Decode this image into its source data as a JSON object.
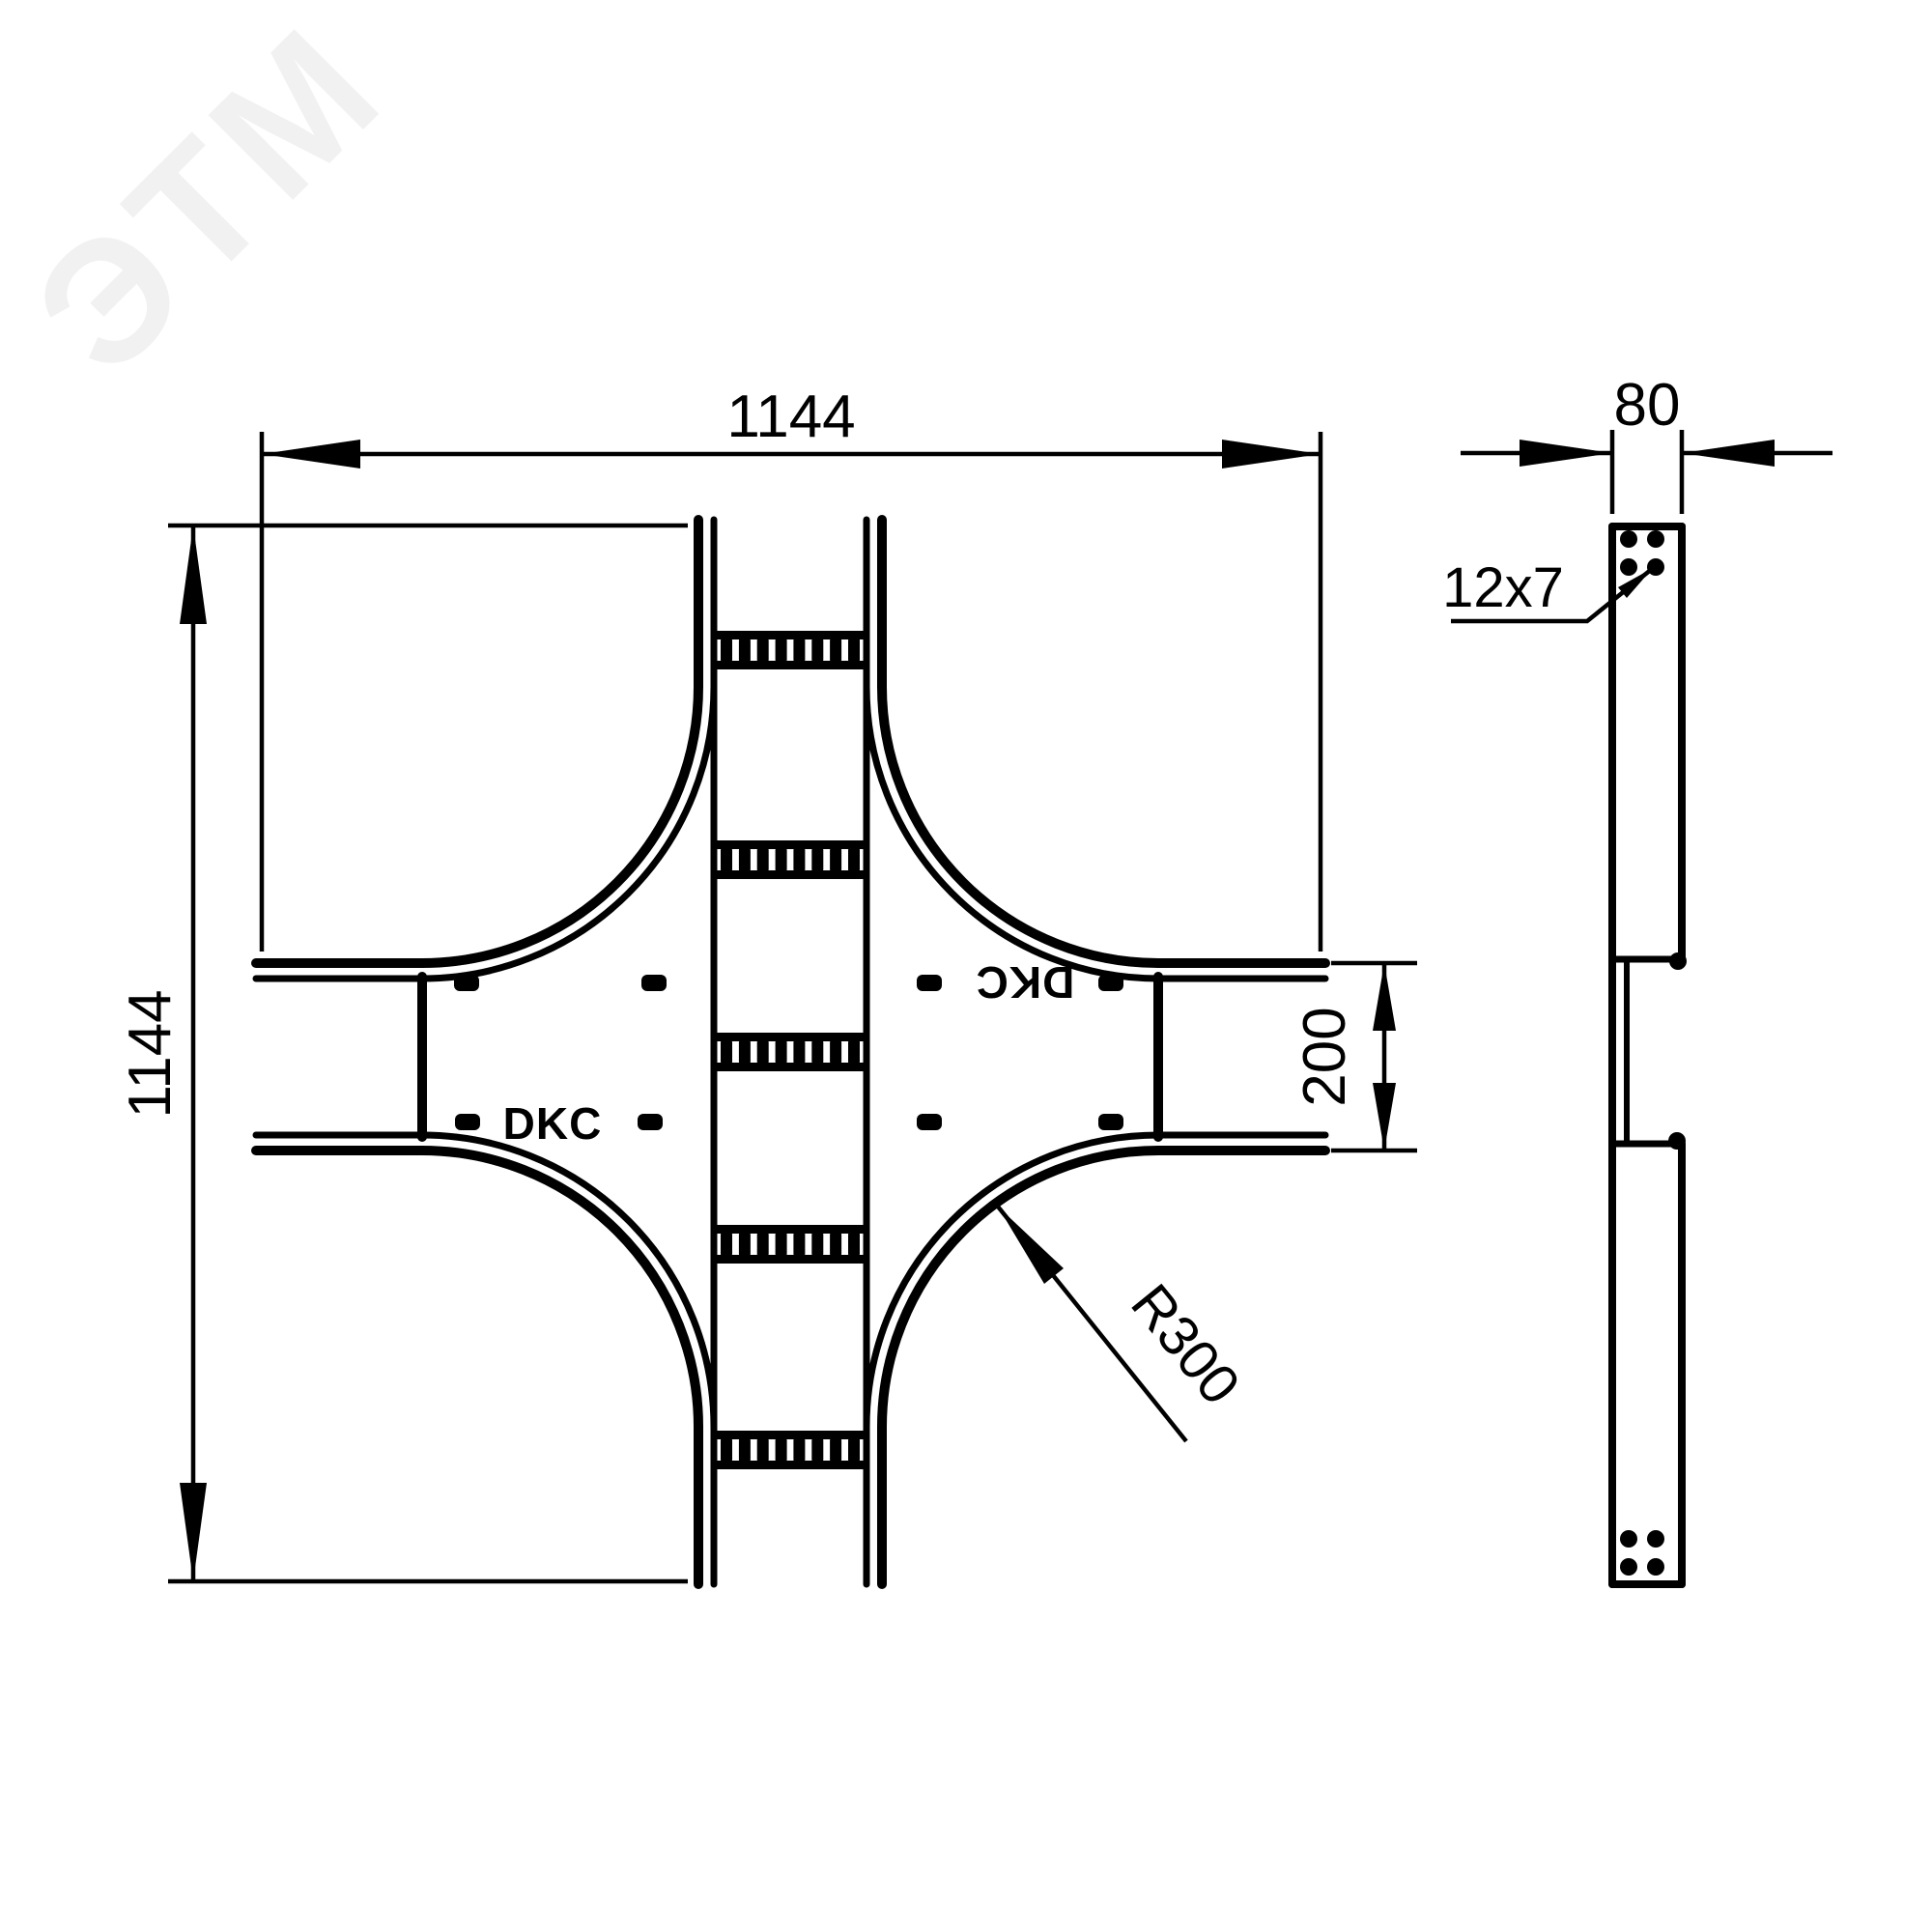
{
  "watermark": {
    "text": "ЭТМ"
  },
  "top_view": {
    "brand": {
      "normal": "DKC",
      "rotated": "DKC"
    },
    "dims": {
      "overall_width": "1144",
      "overall_height": "1144",
      "branch_width": "200",
      "bend_radius": "R300"
    }
  },
  "side_view": {
    "dims": {
      "depth": "80",
      "hole_slot": "12x7"
    }
  }
}
